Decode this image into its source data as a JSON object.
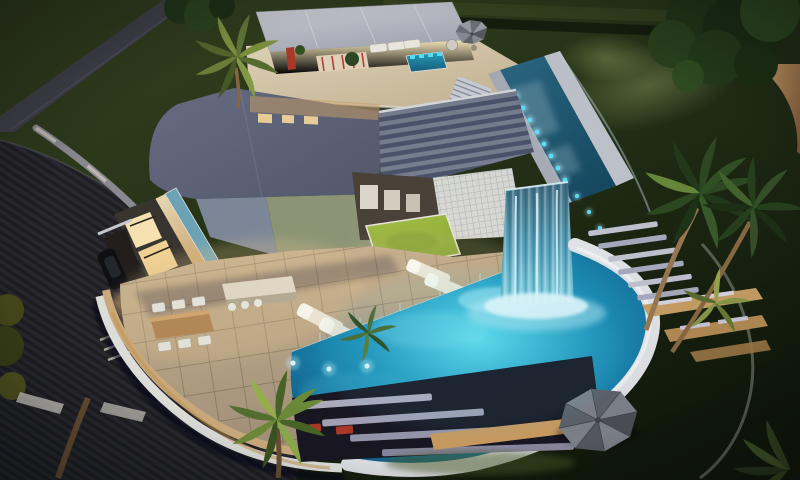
{
  "scene": {
    "description": "Aerial dusk 3D architectural rendering of a modern luxury villa: curved infinity pool with glass waterfall tower, rooftop lap pool with LED edge lights, rooftop lounge pavilion with spa, louvered pergola over a courtyard lawn patch, stone-tiled terrace with dining set and sun loungers, curved dark driveway with parked car, palm trees and night-lit gardens",
    "setting": "night exterior, warm interior lighting",
    "view": "high-angle aerial three-quarter view"
  },
  "objects": [
    "modern villa",
    "rooftop pavilion lounge",
    "rooftop spa",
    "rooftop lap pool with LED edge",
    "louvered pergola roof",
    "white lattice screen",
    "courtyard lawn patch",
    "glass waterfall tower",
    "curved infinity pool",
    "stone tile terrace",
    "outdoor dining set",
    "outdoor kitchen island",
    "sun loungers",
    "pouf seats",
    "patio umbrella",
    "large gray parasol",
    "louvered deck steps",
    "wooden framed steps",
    "curved driveway",
    "parked car",
    "retaining wall",
    "garden path",
    "palm trees",
    "garden trees",
    "spotlit lawn"
  ],
  "colors": {
    "grass_light": "#36431f",
    "grass_dark": "#10180a",
    "path_gray": "#43434c",
    "driveway": "#26262c",
    "retaining_wall": "#8f8d95",
    "roof_main_light": "#6a7188",
    "roof_main_dark": "#555a6e",
    "roof_lower_blue": "#7e8a9b",
    "roof_lower_sage": "#8d9676",
    "fascia_cream": "#f2e2bc",
    "clerestory_teal": "#6fa8ba",
    "pavilion_roof": "#d4d7dd",
    "interior_glow": "#ffeec2",
    "accent_red": "#b23a28",
    "spa_water": "#2aa3c4",
    "led_cyan": "#5ce4fa",
    "lap_pool_light": "#2c6a85",
    "lap_pool_deep": "#174a63",
    "waterfall_top": "#3f6d82",
    "waterfall_bottom": "#8edcec",
    "pool_center": "#5fe0f2",
    "pool_mid": "#1e92bc",
    "pool_edge": "#0c4f7a",
    "pool_rim_white": "#e4e6ea",
    "terrace_light": "#cdb897",
    "terrace_dark": "#9b8a74",
    "wood_band": "#cf9f62",
    "lawn_patch_light": "#a8c24a",
    "lawn_patch_dark": "#7fa42e",
    "lounger_cream": "#efe8d6",
    "palm_frond": "#2e4a22",
    "palm_trunk": "#9a7a52",
    "parasol_gray": "#80848c",
    "step_slat": "#c3c5d2"
  }
}
